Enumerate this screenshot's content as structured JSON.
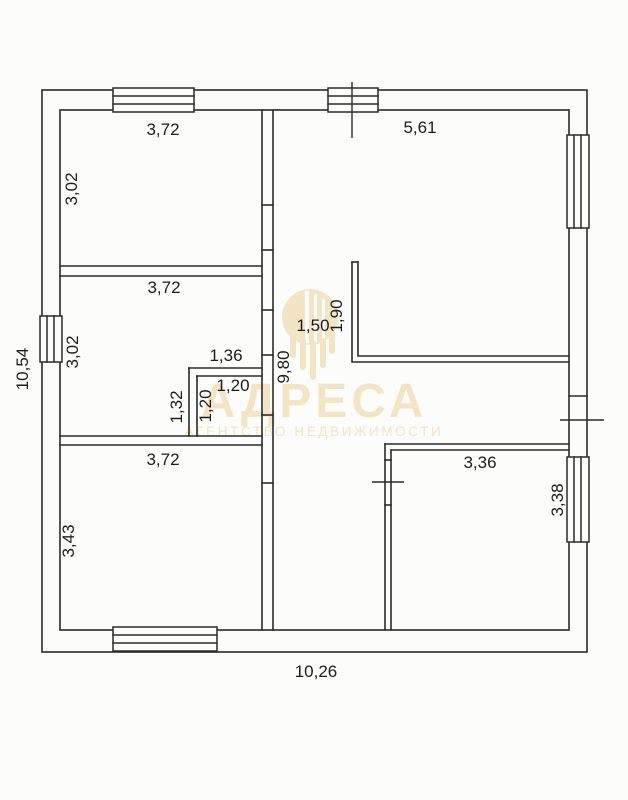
{
  "watermark": {
    "brand": "АДРЕСА",
    "tagline": "АГЕНТСТВО НЕДВИЖИМОСТИ",
    "color": "#f3e4c1",
    "logo_inner_color": "#fcfcfb"
  },
  "plan": {
    "line_color": "#2b2b2b",
    "text_color": "#1c1c1c",
    "paper_color": "#fcfcfb",
    "dims": {
      "room_top_left_width": "3,72",
      "room_top_left_height": "3,02",
      "living_area_width": "5,61",
      "room_mid_left_width": "3,72",
      "room_mid_left_height": "3,02",
      "closet_outer_width": "1,36",
      "closet_inner_width": "1,20",
      "closet_outer_height": "1,32",
      "closet_inner_height": "1,20",
      "hall_inner_height": "9,80",
      "partition_offset": "1,50",
      "partition_length": "1,90",
      "room_bottom_left_width": "3,72",
      "room_bottom_left_height": "3,43",
      "room_bottom_right_width": "3,36",
      "room_bottom_right_height": "3,38",
      "overall_width": "10,26",
      "overall_height": "10,54"
    }
  }
}
